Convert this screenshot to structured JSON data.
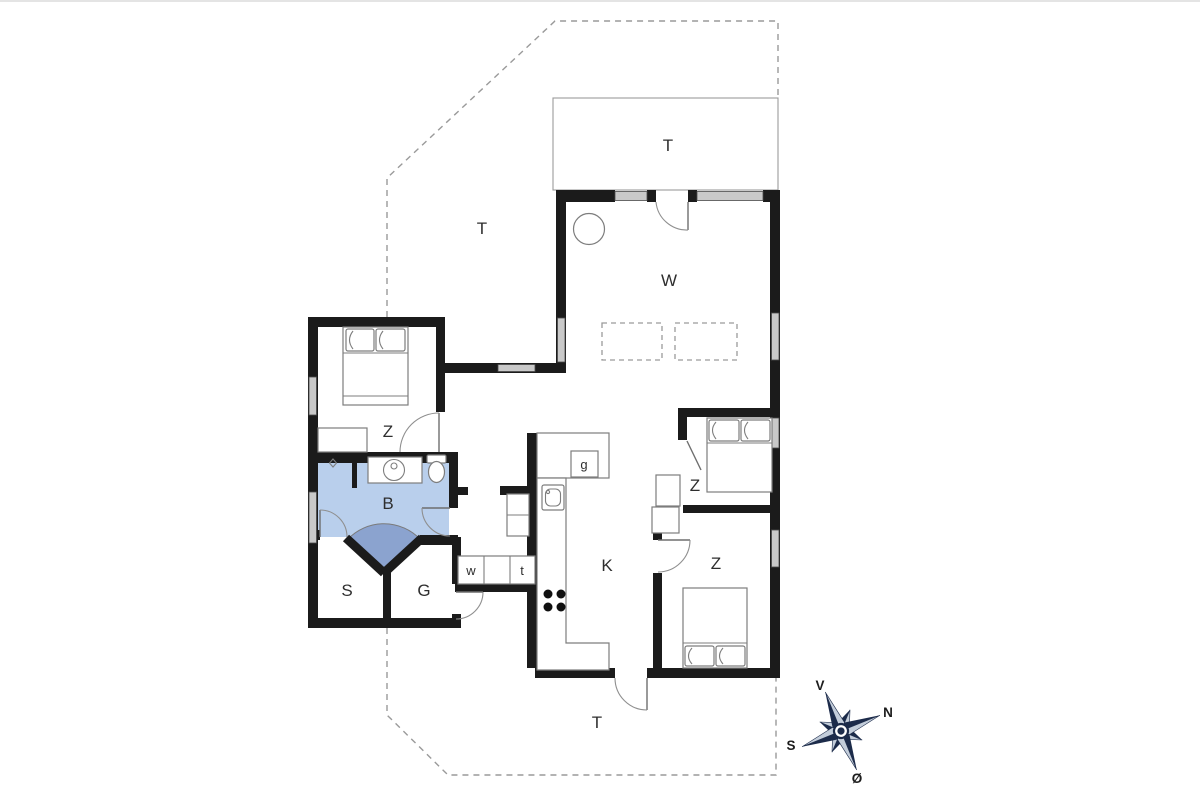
{
  "floorplan": {
    "rooms": {
      "terrace_north": "T",
      "terrace_west": "T",
      "terrace_south": "T",
      "living_room": "W",
      "bedroom_nw": "Z",
      "bedroom_east": "Z",
      "bedroom_se": "Z",
      "bathroom": "B",
      "room_s": "S",
      "room_g": "G",
      "kitchen": "K",
      "utility_w": "w",
      "utility_t": "t",
      "appliance_g": "g"
    },
    "compass": {
      "west": "V",
      "north": "N",
      "south": "S",
      "east": "Ø"
    },
    "colors": {
      "wall": "#1b1b1b",
      "window": "#c9c9c9",
      "outline": "#7d7d7d",
      "dash": "#9a9a9a",
      "label": "#2e2e2e",
      "bath": "#b9cfec",
      "bath_fan": "#8ba3cf",
      "compass_dark": "#1c2b4a",
      "compass_light": "#c3cdda"
    }
  }
}
